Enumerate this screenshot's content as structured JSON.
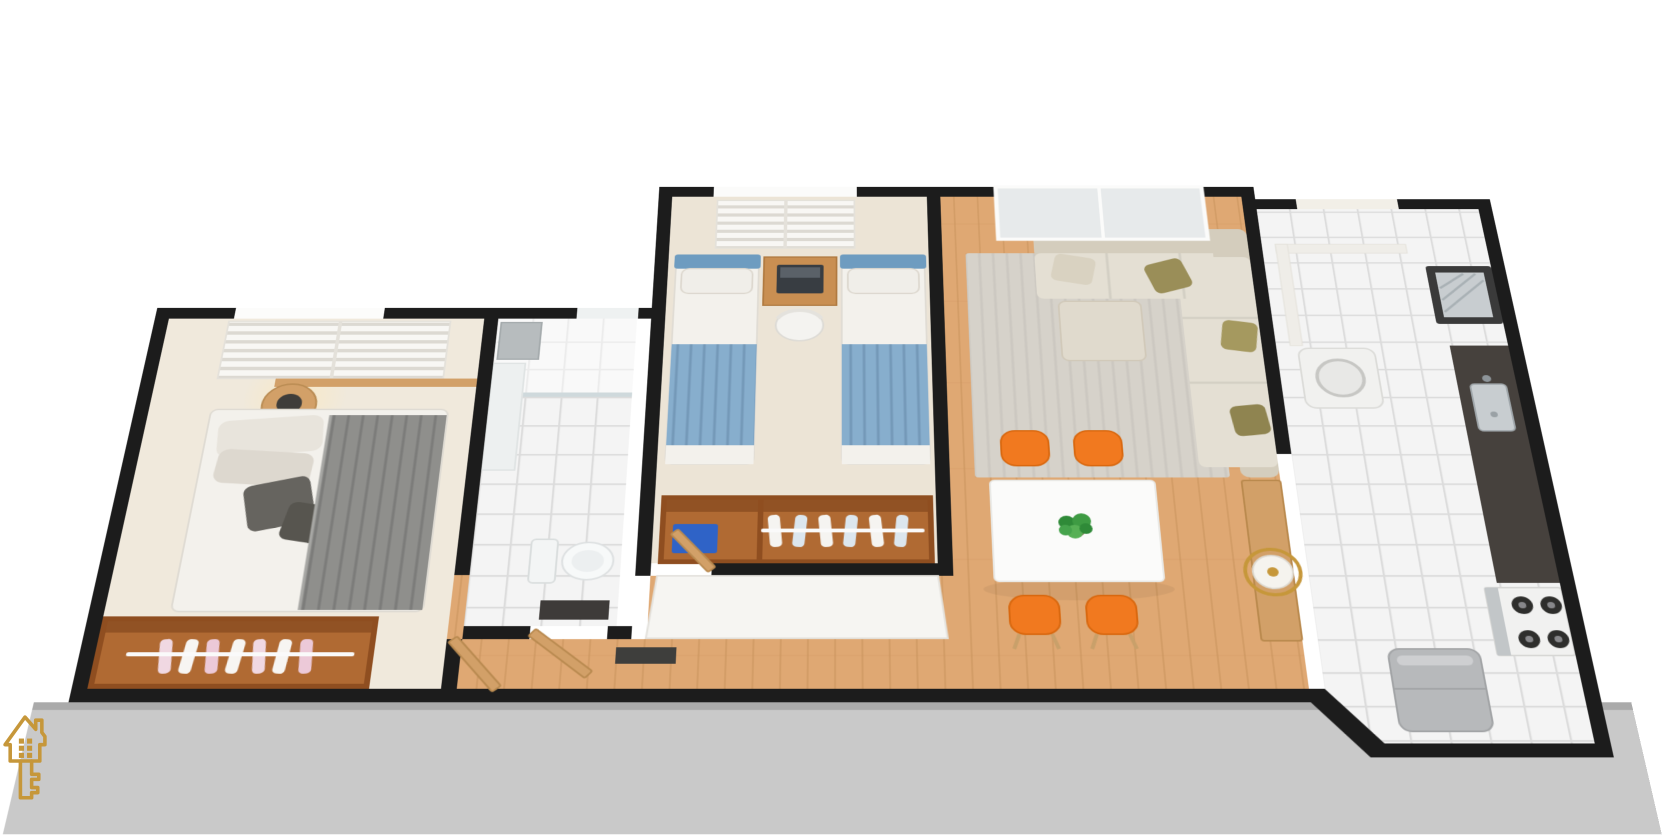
{
  "scene": {
    "type": "3d-apartment-floor-plan-render",
    "background": "#ffffff"
  },
  "palette": {
    "wall": "#1c1c1c",
    "slab": "#c9c9c9",
    "slab_edge": "#9d9d9d",
    "floor_wood": "#dfa873",
    "floor_wood_dark": "#c9935c",
    "floor_cream": "#f0e9dc",
    "floor_cream2": "#ece4d6",
    "tile": "#f4f4f4",
    "tile_line": "#dcdcdc",
    "linen": "#f3f1ec",
    "bed_gray": "#8f8f8c",
    "pillow_dark": "#66645f",
    "blue_bed": "#87aecd",
    "blue_head": "#6e9cc0",
    "wood_furniture": "#b06a33",
    "wood_dark": "#8f4e20",
    "wood_light": "#d2a068",
    "desk_wood": "#c98f52",
    "sofa": "#e4dfd3",
    "sofa_dark": "#d4cdbd",
    "olive": "#9a8e58",
    "rug": "#d6d2ca",
    "orange": "#f1791f",
    "orange_dark": "#d9680f",
    "table_white": "#fbfbfa",
    "plant_green": "#3e9b43",
    "counter_dark": "#46413d",
    "steel": "#c8cdd0",
    "fridge": "#b7b9bb",
    "glass": "#e7eaeb",
    "gold": "#c6973a",
    "blue_box": "#2f63c7"
  },
  "branding": {
    "logo_icon": "house-key-icon",
    "logo_color": "#c6973a"
  },
  "rooms": [
    {
      "name": "master-bedroom",
      "furniture": [
        "double-bed",
        "gray-blanket",
        "pillows",
        "round-nightstand",
        "table-lamp",
        "open-wardrobe-with-clothes",
        "window-blinds"
      ]
    },
    {
      "name": "bathroom",
      "furniture": [
        "shower-area",
        "glass-partition",
        "wall-niche",
        "toilet",
        "dark-mat",
        "wood-door"
      ]
    },
    {
      "name": "second-bedroom",
      "furniture": [
        "single-bed-left",
        "single-bed-right",
        "study-desk",
        "laptop",
        "white-chair",
        "wardrobe-with-hangers",
        "blue-storage-box",
        "window-blinds"
      ]
    },
    {
      "name": "living-dining-room",
      "furniture": [
        "l-shaped-sofa",
        "olive-pillows",
        "area-rug",
        "panoramic-window",
        "dining-table",
        "potted-plant",
        "orange-chair-x4",
        "gold-floor-lamp",
        "wood-sideboard"
      ]
    },
    {
      "name": "kitchen-service-area",
      "furniture": [
        "laundry-tank",
        "washing-machine",
        "dark-countertop",
        "steel-sink",
        "four-burner-stove",
        "refrigerator"
      ]
    }
  ]
}
